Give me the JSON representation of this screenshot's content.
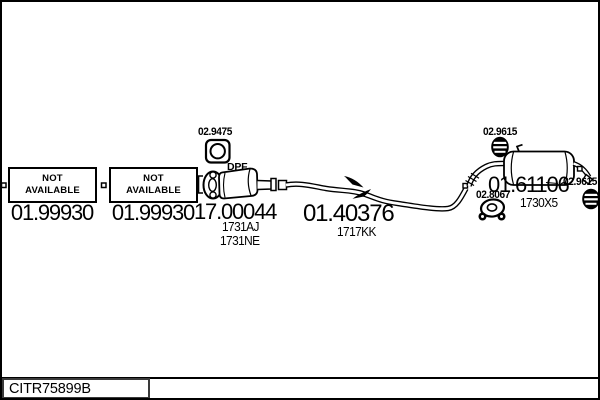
{
  "diagram": {
    "footer_code": "CITR75899B",
    "not_available_1": {
      "label": "NOT\nAVAILABLE",
      "number": "01.99930"
    },
    "not_available_2": {
      "label": "NOT\nAVAILABLE",
      "number": "01.99930"
    },
    "front_gasket": {
      "number": "02.9475"
    },
    "dpf": {
      "tag": "DPF",
      "number": "17.00044",
      "variant1": "1731AJ",
      "variant2": "1731NE"
    },
    "mid_pipe": {
      "number": "01.40376",
      "variant": "1717KK"
    },
    "rear_gasket": {
      "number": "02.8067"
    },
    "rear_muffler": {
      "number": "01.61106",
      "variant": "1730X5"
    },
    "hanger_top": {
      "number": "02.9615"
    },
    "hanger_right": {
      "number": "02.9615"
    },
    "colors": {
      "line": "#000000",
      "background": "#ffffff"
    }
  }
}
